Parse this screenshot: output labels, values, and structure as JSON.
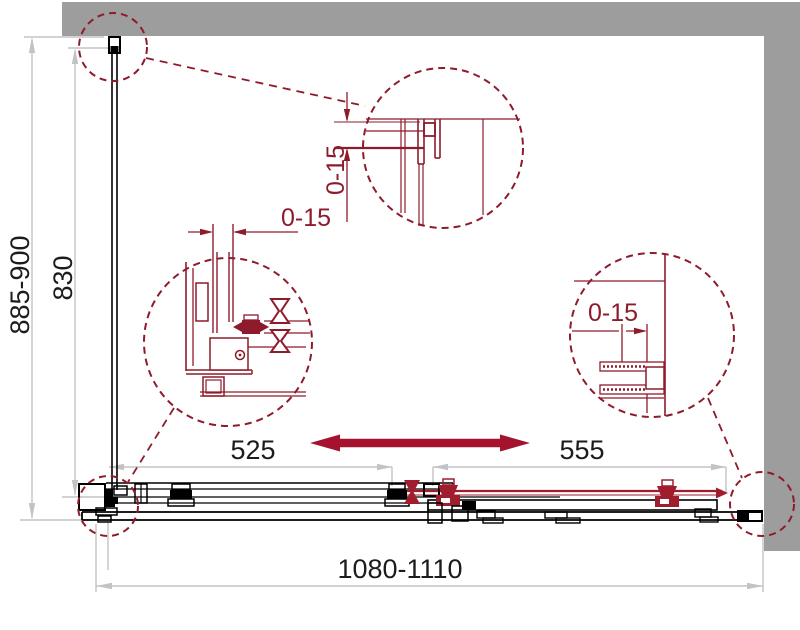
{
  "drawing": {
    "title": "corner-sliding-shower-enclosure-dimension-drawing",
    "labels": {
      "width_range": "1080-1110",
      "height_range": "885-900",
      "glass_height": "830",
      "left_panel_width": "525",
      "right_panel_width": "555",
      "adjust_top": "0-15",
      "adjust_left": "0-15",
      "adjust_right": "0-15"
    },
    "colors": {
      "wall": "#9d9d9d",
      "dimension": "#c3c3c3",
      "detail_red": "#8e1b2c",
      "arrow_red": "#a5122d",
      "hardware_red": "#a01d2e",
      "line_black": "#000000"
    }
  }
}
